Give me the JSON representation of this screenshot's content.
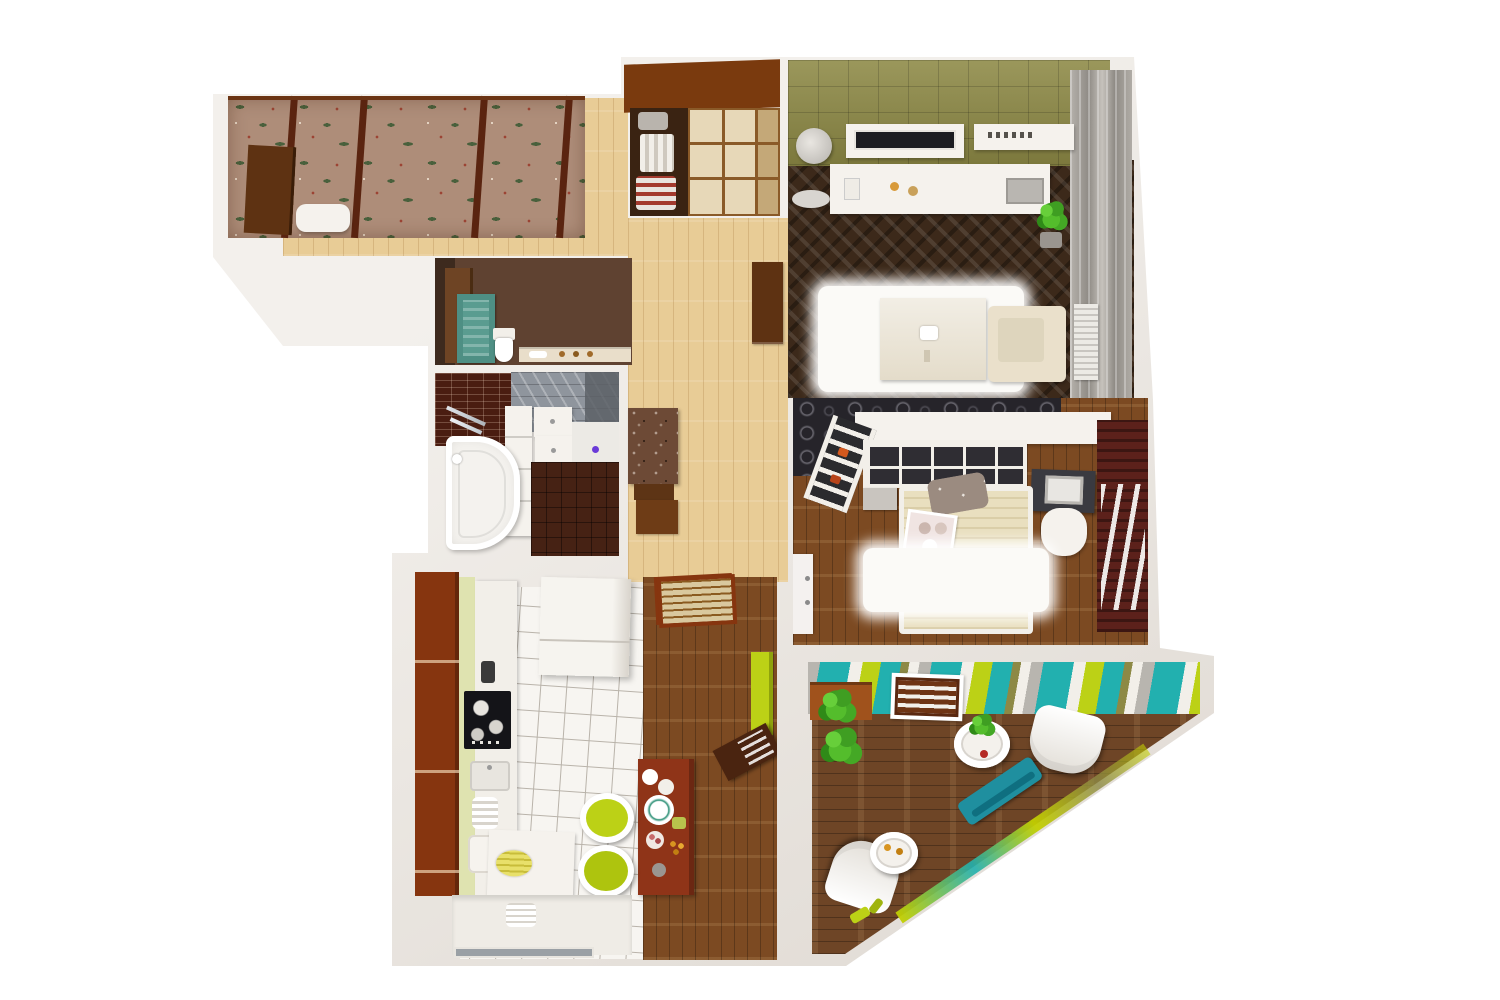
{
  "scene": {
    "type": "3d-apartment-floor-plan-render",
    "view": "isometric top-down cutaway",
    "background": "#ffffff",
    "visible_text": ""
  },
  "palette": {
    "wall": "#f3f0ec",
    "wall-shadow": "#ddd7d0",
    "wood-light": "#e8cc96",
    "wood-mid": "#7c4a22",
    "wood-terrace": "#6e4526",
    "herringbone-dark": "#3c291a",
    "tile-white": "#f7f5f1",
    "tile-grout": "#b9b3aa",
    "olive-wall": "#8d8945",
    "dark-wall": "#26242a",
    "floral-base": "#ae8d79",
    "floral-green": "#49603c",
    "floral-red": "#9c4434",
    "maroon-wardrobe": "#5c211b",
    "brick-wall": "#4a1d11",
    "gray-tile": "#8f959d",
    "bath-floor": "#462214",
    "brown-cabinet": "#86350f",
    "cream-panel": "#e7d8b8",
    "table-wood": "#8f3418",
    "lime": "#bcd116",
    "teal": "#22b0af",
    "stripe-gray": "#b8b5af",
    "plant-green": "#45b32a",
    "white-furniture": "#f5f2ed",
    "cream-furniture": "#eae0cb",
    "bed-beige": "#e9dfbf",
    "curtain-gray": "#a8a49e"
  },
  "rooms": [
    {
      "id": "loggia",
      "name": "loggia with floral canopy"
    },
    {
      "id": "hallway",
      "name": "entry hallway"
    },
    {
      "id": "living-room",
      "name": "living room with TV wall"
    },
    {
      "id": "bedroom",
      "name": "bedroom with shelving headboard"
    },
    {
      "id": "terrace",
      "name": "corner terrace with striped wall"
    },
    {
      "id": "kitchen",
      "name": "kitchen and dining"
    },
    {
      "id": "bathroom",
      "name": "bathroom"
    },
    {
      "id": "wc",
      "name": "wc / storage room"
    }
  ],
  "furniture": {
    "loggia": [
      "floral-canopy",
      "entry-door",
      "bench"
    ],
    "hallway": [
      "sliding-wardrobe",
      "console-table",
      "tall-cabinet",
      "kitchen-shoji-door"
    ],
    "living_room": [
      "wall-tv",
      "wall-shelf",
      "sideboard",
      "laptop",
      "floor-lamp",
      "potted-plant",
      "shag-rug",
      "platform-daybed",
      "corner-armchair",
      "radiator",
      "curtain-wall"
    ],
    "bedroom": [
      "headboard-cubby-shelf",
      "ladder-shelf",
      "desk",
      "monitor",
      "chair",
      "double-bed",
      "pillow",
      "breakfast-tray",
      "fur-rug",
      "maroon-wardrobe",
      "white-door"
    ],
    "terrace": [
      "striped-feature-wall",
      "slatted-door",
      "planter-with-plants",
      "round-side-table",
      "lounge-chair-1",
      "teal-bench",
      "lounge-chair-2",
      "small-round-table",
      "lime-accents"
    ],
    "kitchen": [
      "tall-cabinet-column",
      "worktop",
      "gas-hob",
      "sink",
      "fridge",
      "shoji-door",
      "green-cabinet",
      "angled-sideboard",
      "dining-table",
      "green-chair-1",
      "green-chair-2",
      "plate-stack",
      "prep-table",
      "bottom-counter",
      "window"
    ],
    "bathroom": [
      "brick-wall",
      "gray-tiled-wall",
      "towel-bar",
      "storage-column",
      "vanity-sinks",
      "corner-bathtub",
      "dark-tile-floor"
    ],
    "wc": [
      "door",
      "teal-cabinet",
      "toilet",
      "wall-shelf"
    ]
  }
}
